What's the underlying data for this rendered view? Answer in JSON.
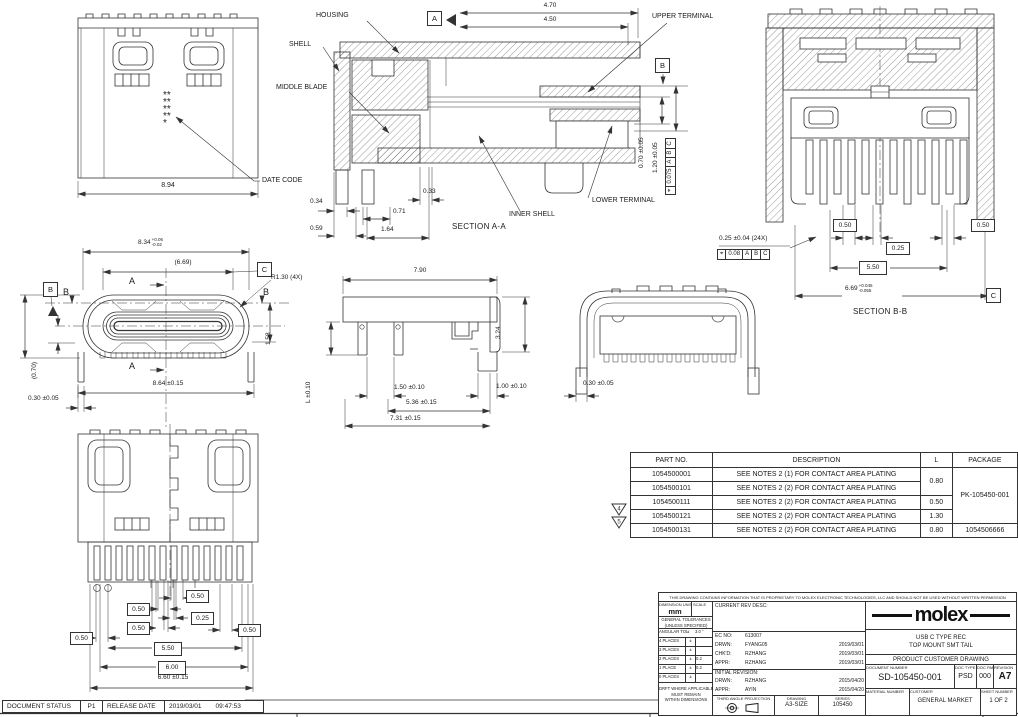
{
  "callouts": {
    "housing": "HOUSING",
    "shell": "SHELL",
    "middle_blade": "MIDDLE BLADE",
    "date_code": "DATE CODE",
    "upper_terminal": "UPPER TERMINAL",
    "lower_terminal": "LOWER TERMINAL",
    "inner_shell": "INNER SHELL"
  },
  "sections": {
    "aa": "SECTION A-A",
    "bb": "SECTION B-B"
  },
  "datums": {
    "a": "A",
    "b": "B",
    "c": "C"
  },
  "view_top": {
    "width": "8.94",
    "date_code_marks": "*********"
  },
  "sec_aa": {
    "d470": "4.70",
    "d450": "4.50",
    "d034": "0.34",
    "d059": "0.59",
    "d071": "0.71",
    "d164": "1.64",
    "d033": "0.33",
    "d070": "0.70 ±0.05",
    "d120": "1.20 ±0.05",
    "fcf": {
      "sym": "⌖",
      "tol": "0.075",
      "da": "A",
      "db": "B",
      "dc": "C"
    }
  },
  "sec_bb": {
    "d050l": "0.50",
    "d050r": "0.50",
    "d025": "0.25",
    "pitch": "0.25 ±0.04 (24X)",
    "fcf": {
      "sym": "⌖",
      "tol": "0.08",
      "da": "A",
      "db": "B",
      "dc": "C"
    },
    "d550": "5.50",
    "d669": {
      "v": "6.69",
      "tp": "+0.045",
      "tm": "-0.055"
    }
  },
  "view_face": {
    "d834": {
      "v": "8.34",
      "tp": "+0.06",
      "tm": "-0.02"
    },
    "d669ref": "(6.69)",
    "r130": "R1.30 (4X)",
    "d256": "2.56 ±0.04",
    "d158": "1.58",
    "d070ref": "(0.70)",
    "d864": "8.64 ±0.15",
    "d030": "0.30 ±0.05"
  },
  "view_side": {
    "d790": "7.90",
    "d324": "3.24",
    "dl": "L ±0.10",
    "d150": "1.50 ±0.10",
    "d536": "5.36 ±0.15",
    "d731": "7.31 ±0.15",
    "d100": "1.00 ±0.10"
  },
  "view_back": {
    "d030": "0.30 ±0.05"
  },
  "view_bottom": {
    "b050a": "0.50",
    "b050b": "0.50",
    "b025": "0.25",
    "b050c": "0.50",
    "b050d": "0.50",
    "b050e": "0.50",
    "b550": "5.50",
    "b600": "6.00",
    "d660": "6.60 ±0.15"
  },
  "parts_table": {
    "headers": {
      "part": "PART NO.",
      "desc": "DESCRIPTION",
      "l": "L",
      "pkg": "PACKAGE"
    },
    "rows": [
      {
        "part": "1054500001",
        "desc": "SEE NOTES 2 (1) FOR CONTACT AREA PLATING"
      },
      {
        "part": "1054500101",
        "desc": "SEE NOTES 2 (2) FOR CONTACT AREA PLATING"
      },
      {
        "part": "1054500111",
        "desc": "SEE NOTES 2 (2) FOR CONTACT AREA PLATING",
        "l": "0.50"
      },
      {
        "part": "1054500121",
        "desc": "SEE NOTES 2 (2) FOR CONTACT AREA PLATING",
        "l": "1.30"
      },
      {
        "part": "1054500131",
        "desc": "SEE NOTES 2 (2) FOR CONTACT AREA PLATING",
        "l": "0.80",
        "pkg": "1054506666"
      }
    ],
    "l_merged": "0.80",
    "pkg_merged": "PK-105450-001",
    "flags": {
      "f4": "4",
      "f5": "5"
    }
  },
  "title_block": {
    "proprietary": "THIS DRAWING CONTAINS INFORMATION THAT IS PROPRIETARY TO MOLEX ELECTRONIC TECHNOLOGIES, LLC AND SHOULD NOT BE USED WITHOUT WRITTEN PERMISSION",
    "dimension_units_label": "DIMENSION UNITS",
    "units": "mm",
    "scale_label": "SCALE",
    "general_tol_1": "GENERAL TOLERANCES",
    "general_tol_2": "(UNLESS SPECIFIED)",
    "angular_label": "ANGULAR TOL",
    "angular_pm": "±",
    "angular_val": "3.0 °",
    "tol_rows": [
      {
        "label": "4 PLACES",
        "pm": "±",
        "val": ""
      },
      {
        "label": "3 PLACES",
        "pm": "±",
        "val": ""
      },
      {
        "label": "2 PLACES",
        "pm": "±",
        "val": "0.2"
      },
      {
        "label": "1 PLACE",
        "pm": "±",
        "val": "0.2"
      },
      {
        "label": "0 PLACES",
        "pm": "±",
        "val": ""
      }
    ],
    "drft_1": "DRFT WHERE APPLICABLE",
    "drft_2": "MUST REMAIN",
    "drft_3": "WITHIN DIMENSIONS",
    "current_rev_label": "CURRENT REV DESC:",
    "ec_label": "EC NO:",
    "ec_no": "613007",
    "rev_rows": [
      {
        "label": "DRWN:",
        "name": "FYANG05",
        "date": "2019/03/01"
      },
      {
        "label": "CHK'D:",
        "name": "RZHANG",
        "date": "2019/03/01"
      },
      {
        "label": "APPR:",
        "name": "RZHANG",
        "date": "2019/03/01"
      }
    ],
    "initial_rev_label": "INITIAL REVISION:",
    "init_rows": [
      {
        "label": "DRWN:",
        "name": "RZHANG",
        "date": "2015/04/20"
      },
      {
        "label": "APPR:",
        "name": "AYIN",
        "date": "2015/04/20"
      }
    ],
    "third_angle_label": "THIRD ANGLE PROJECTION",
    "drawing_label": "DRAWING",
    "drawing_size": "A3-SIZE",
    "series_label": "SERIES",
    "series": "105450",
    "brand": "molex",
    "product_title_1": "USB C TYPE REC",
    "product_title_2": "TOP MOUNT SMT TAIL",
    "doc_kind": "PRODUCT CUSTOMER DRAWING",
    "document_number_label": "DOCUMENT NUMBER",
    "document_number": "SD-105450-001",
    "doc_type_label": "DOC TYPE",
    "doc_type": "PSD",
    "doc_part_label": "DOC PART",
    "doc_part": "000",
    "revision_label": "REVISION",
    "revision": "A7",
    "material_number_label": "MATERIAL NUMBER",
    "customer_label": "CUSTOMER",
    "customer": "GENERAL MARKET",
    "sheet_number_label": "SHEET NUMBER",
    "sheet_number": "1 OF 2"
  },
  "status_bar": {
    "label": "DOCUMENT STATUS",
    "value": "P1",
    "release_label": "RELEASE DATE",
    "date": "2019/03/01",
    "time": "09:47:53"
  }
}
